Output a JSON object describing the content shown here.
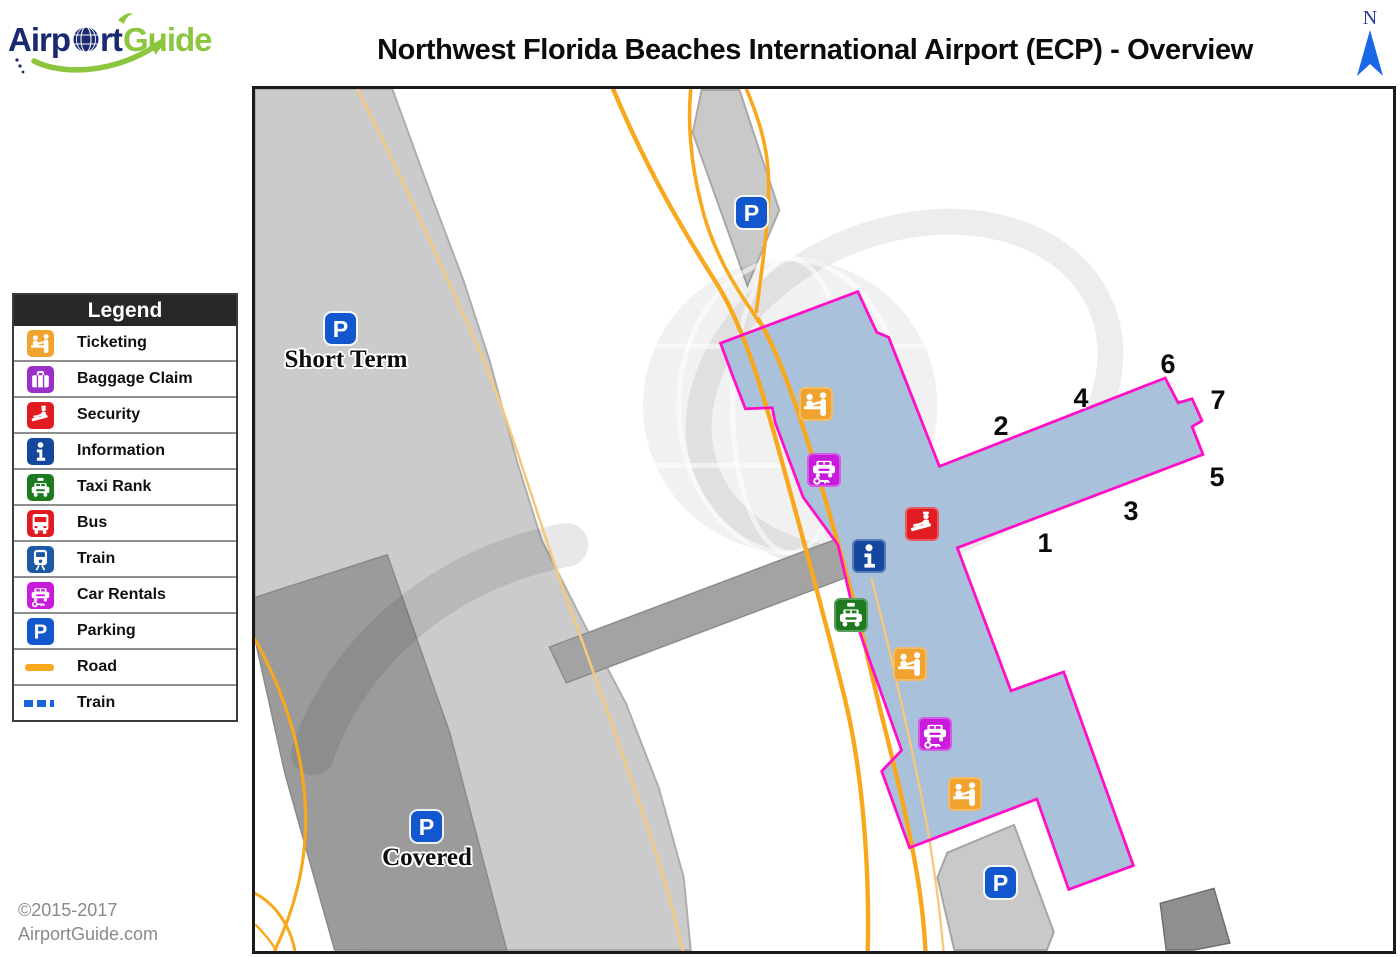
{
  "header": {
    "logo": {
      "full_name": "AirportGuide",
      "part1": "Airp",
      "part2": "rt",
      "part3": "Guide"
    },
    "title": "Northwest Florida Beaches International Airport (ECP) - Overview",
    "north_label": "N"
  },
  "legend": {
    "title": "Legend",
    "items": [
      {
        "label": "Ticketing",
        "icon": "ticketing-icon",
        "color": "#F0A32F"
      },
      {
        "label": "Baggage Claim",
        "icon": "baggage-claim-icon",
        "color": "#9B30C8"
      },
      {
        "label": "Security",
        "icon": "security-icon",
        "color": "#E01B22"
      },
      {
        "label": "Information",
        "icon": "information-icon",
        "color": "#15489C"
      },
      {
        "label": "Taxi Rank",
        "icon": "taxi-rank-icon",
        "color": "#1E7A1E"
      },
      {
        "label": "Bus",
        "icon": "bus-icon",
        "color": "#E01B22"
      },
      {
        "label": "Train",
        "icon": "train-icon",
        "color": "#1C5AA6"
      },
      {
        "label": "Car Rentals",
        "icon": "car-rentals-icon",
        "color": "#C81BDC"
      },
      {
        "label": "Parking",
        "icon": "parking-icon",
        "color": "#1257CE"
      },
      {
        "label": "Road",
        "icon": "road-line",
        "color": "#F7A81C"
      },
      {
        "label": "Train",
        "icon": "train-line",
        "color": "#1C64D9"
      }
    ]
  },
  "map": {
    "parking_letter": "P",
    "labels": {
      "short_term": "Short Term",
      "covered": "Covered"
    },
    "gates": [
      "1",
      "2",
      "3",
      "4",
      "5",
      "6",
      "7"
    ],
    "colors": {
      "terminal_fill": "#A9C1DA",
      "terminal_border": "#FF10C8",
      "road": "#F7A81C",
      "road_minor": "#F6C87D",
      "short_term_lot": "#CBCBCB",
      "covered_garage": "#9B9B9B"
    }
  },
  "footer": {
    "copyright_line1": "©2015-2017",
    "copyright_line2": "AirportGuide.com"
  }
}
